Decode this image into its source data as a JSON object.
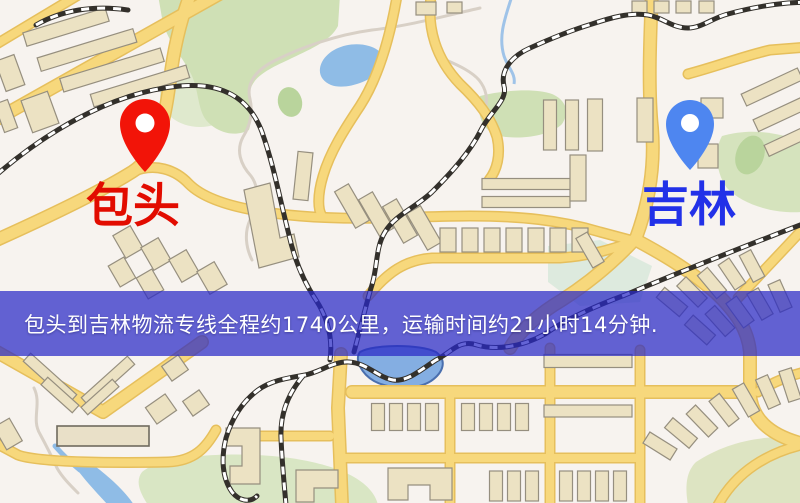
{
  "banner": {
    "text": "包头到吉林物流专线全程约1740公里，运输时间约21小时14分钟.",
    "background_color": "#2828c6",
    "background_opacity": "0.72",
    "text_color": "#ffffff"
  },
  "map": {
    "origin": {
      "name": "包头",
      "label_color": "#e20c00",
      "pin_color": "#f21408",
      "pin_icon": "red-map-pin"
    },
    "destination": {
      "name": "吉林",
      "label_color": "#2231e8",
      "pin_color": "#4e86f0",
      "pin_icon": "blue-map-pin"
    },
    "palette": {
      "background": "#f7f3ef",
      "road": "#f7d87c",
      "road_casing": "#e6bf5c",
      "building": "#ece2c3",
      "building_outline": "#968f7f",
      "park": "#cfe0b5",
      "water": "#8fbce6",
      "railway": "#33302b"
    }
  }
}
